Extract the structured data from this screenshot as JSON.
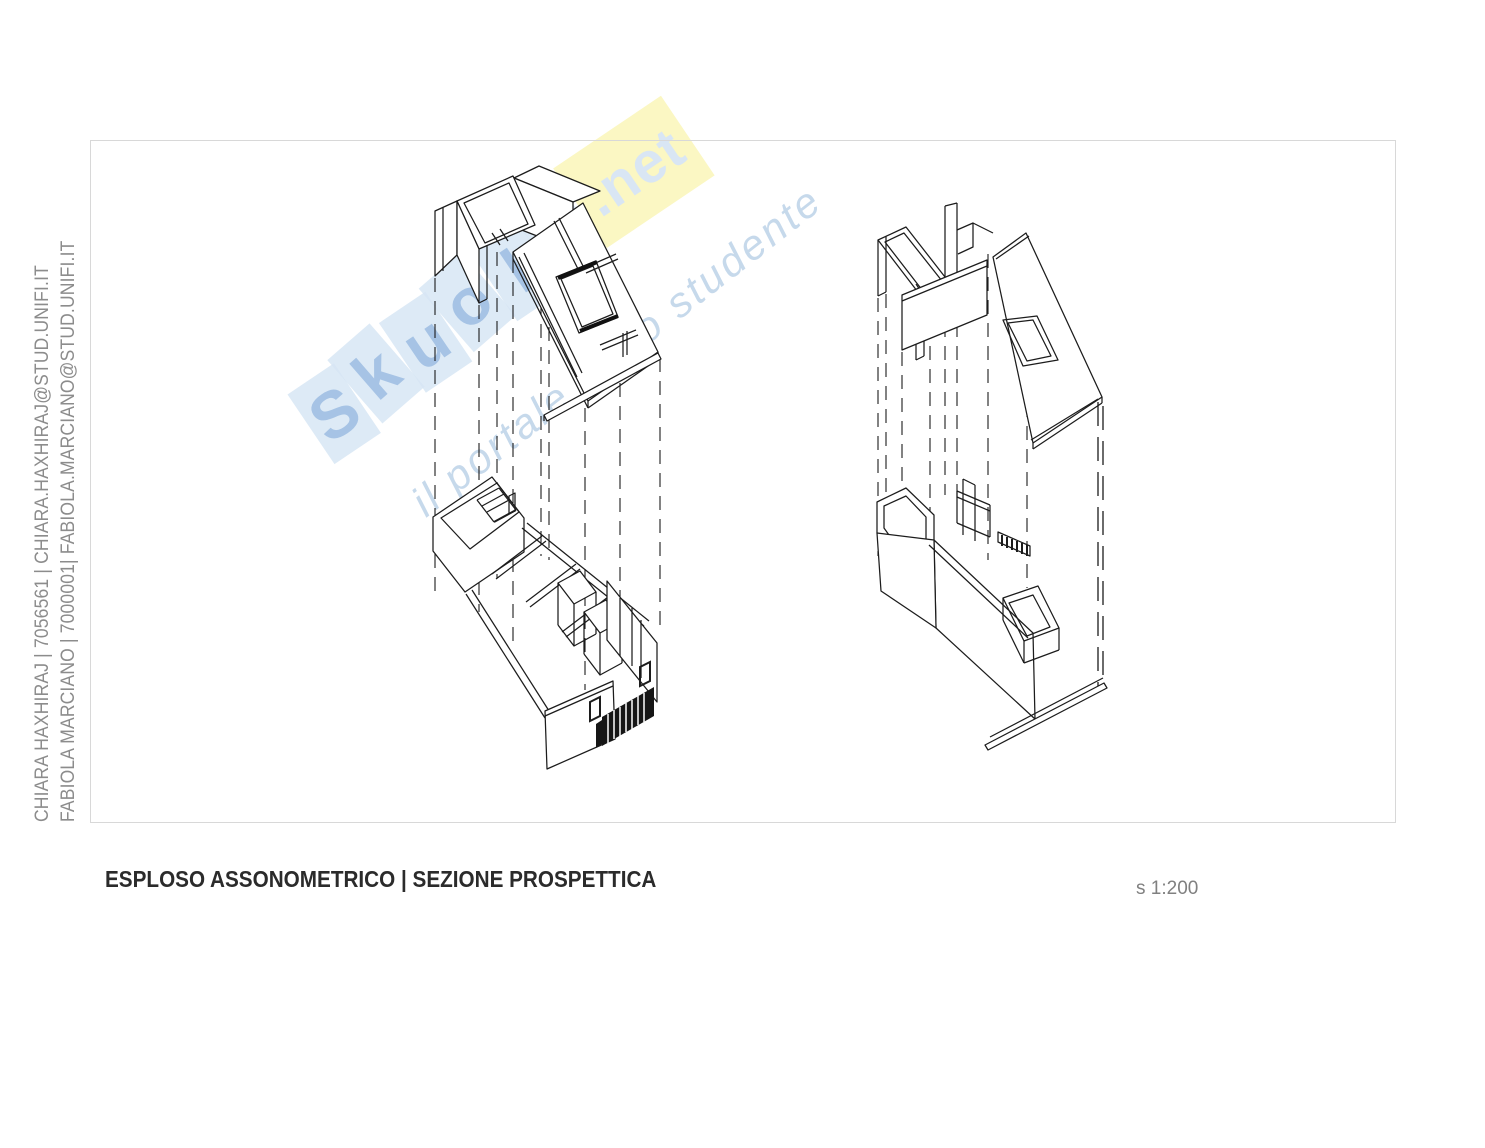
{
  "page": {
    "width": 1485,
    "height": 1148,
    "background": "#ffffff"
  },
  "credits": {
    "line1": "CHIARA HAXHIRAJ | 7056561 | CHIARA.HAXHIRAJ@STUD.UNIFI.IT",
    "line2": "FABIOLA MARCIANO | 7000001| FABIOLA.MARCIANO@STUD.UNIFI.IT",
    "text_color": "#8c8c8c"
  },
  "watermark": {
    "letters": [
      "S",
      "k",
      "u",
      "o",
      "l",
      "a"
    ],
    "suffix": ".net",
    "tagline": "il portale dello studente",
    "tile_blue": "#cfe1f2",
    "tile_yellow": "#f9f3a9",
    "letter_blue": "#7fa9d9",
    "suffix_color": "#c8dcef",
    "tagline_color": "#b9d0e7"
  },
  "canvas": {
    "frame_border_color": "#d8d8d8",
    "line_color": "#1c1c1c"
  },
  "footer": {
    "title": "ESPLOSO ASSONOMETRICO | SEZIONE PROSPETTICA",
    "scale": "s 1:200",
    "title_color": "#2b2b2b",
    "scale_color": "#808080"
  }
}
